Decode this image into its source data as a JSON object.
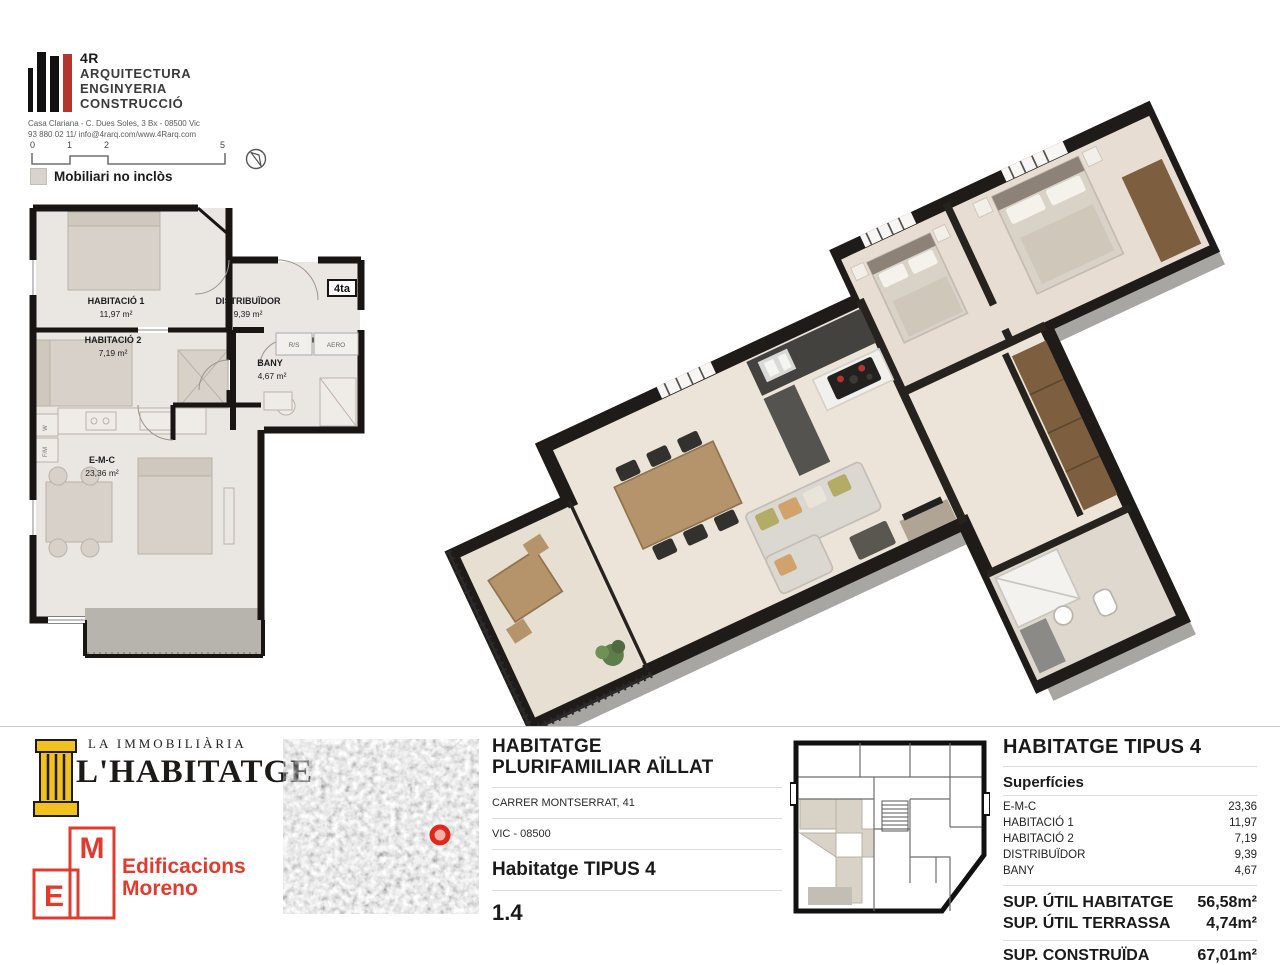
{
  "brand": {
    "name": "4R",
    "line1": "ARQUITECTURA",
    "line2": "ENGINYERIA",
    "line3": "CONSTRUCCIÓ",
    "address1": "Casa Clariana - C. Dues Soles, 3 Bx - 08500 Vic",
    "address2": "93 880 02 11/ info@4rarq.com/www.4Rarq.com"
  },
  "scalebar": {
    "t0": "0",
    "t1": "1",
    "t2": "2",
    "t3": "5"
  },
  "legend": {
    "note": "Mobiliari no inclòs"
  },
  "floorplan": {
    "badge": "4ta",
    "rooms": [
      {
        "name": "HABITACIÓ 1",
        "area": "11,97 m²"
      },
      {
        "name": "HABITACIÓ 2",
        "area": "7,19 m²"
      },
      {
        "name": "DISTRIBUÏDOR",
        "area": "9,39 m²"
      },
      {
        "name": "BANY",
        "area": "4,67 m²"
      },
      {
        "name": "E-M-C",
        "area": "23,36 m²"
      }
    ],
    "small_labels": {
      "rs": "R/S",
      "aero": "AERO",
      "w": "W",
      "fm": "F/M"
    }
  },
  "footer": {
    "agency": {
      "top": "LA IMMOBILIÀRIA",
      "name": "L'HABITATGE"
    },
    "builder": {
      "e": "E",
      "m": "M",
      "name1": "Edificacions",
      "name2": "Moreno"
    },
    "project": {
      "title1": "HABITATGE",
      "title2": "PLURIFAMILIAR AÏLLAT",
      "address": "CARRER MONTSERRAT, 41",
      "city": "VIC - 08500",
      "unit": "Habitatge TIPUS 4",
      "code": "1.4"
    },
    "summary": {
      "title": "HABITATGE TIPUS 4",
      "subtitle": "Superfícies",
      "rows": [
        {
          "label": "E-M-C",
          "value": "23,36"
        },
        {
          "label": "HABITACIÓ 1",
          "value": "11,97"
        },
        {
          "label": "HABITACIÓ 2",
          "value": "7,19"
        },
        {
          "label": "DISTRIBUÏDOR",
          "value": "9,39"
        },
        {
          "label": "BANY",
          "value": "4,67"
        }
      ],
      "totals": [
        {
          "label": "SUP. ÚTIL HABITATGE",
          "value": "56,58m²"
        },
        {
          "label": "SUP. ÚTIL TERRASSA",
          "value": "4,74m²"
        }
      ],
      "built": {
        "label": "SUP. CONSTRUÏDA",
        "value": "67,01m²"
      }
    },
    "colors": {
      "accent_red": "#e23b2e",
      "brand_yellow": "#f2c11c"
    }
  }
}
